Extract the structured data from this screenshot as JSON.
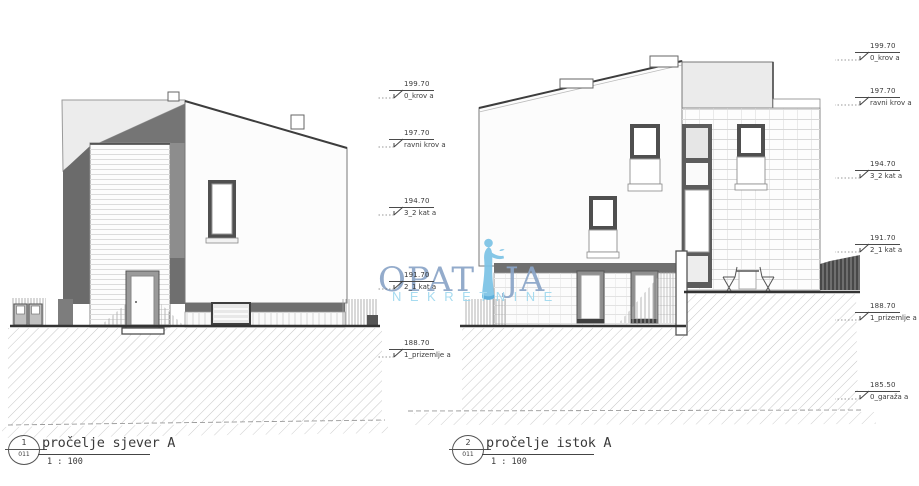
{
  "titles": {
    "left": {
      "number": "1",
      "sheet": "011",
      "title": "pročelje sjever A",
      "scale": "1 : 100"
    },
    "right": {
      "number": "2",
      "sheet": "011",
      "title": "pročelje istok A",
      "scale": "1 : 100"
    }
  },
  "levels_left": [
    {
      "value": "199.70",
      "label": "0_krov a"
    },
    {
      "value": "197.70",
      "label": "ravni krov a"
    },
    {
      "value": "194.70",
      "label": "3_2 kat a"
    },
    {
      "value": "191.70",
      "label": "2_1 kat a"
    },
    {
      "value": "188.70",
      "label": "1_prizemlje a"
    }
  ],
  "levels_right": [
    {
      "value": "199.70",
      "label": "0_krov a"
    },
    {
      "value": "197.70",
      "label": "ravni krov a"
    },
    {
      "value": "194.70",
      "label": "3_2 kat a"
    },
    {
      "value": "191.70",
      "label": "2_1 kat a"
    },
    {
      "value": "188.70",
      "label": "1_prizemlje a"
    },
    {
      "value": "185.50",
      "label": "0_garaža a"
    }
  ],
  "watermark": {
    "part1": "OPAT",
    "part2": "JA",
    "subtitle": "NEKRETNINE"
  },
  "colors": {
    "watermark_text": "#8ba5c8",
    "watermark_statue": "#7cc3e6",
    "watermark_statue_dark": "#54abd9",
    "watermark_subtitle": "#a0d9ef",
    "ground_line": "#333333",
    "shadow_gray": "#6b6b6b"
  }
}
